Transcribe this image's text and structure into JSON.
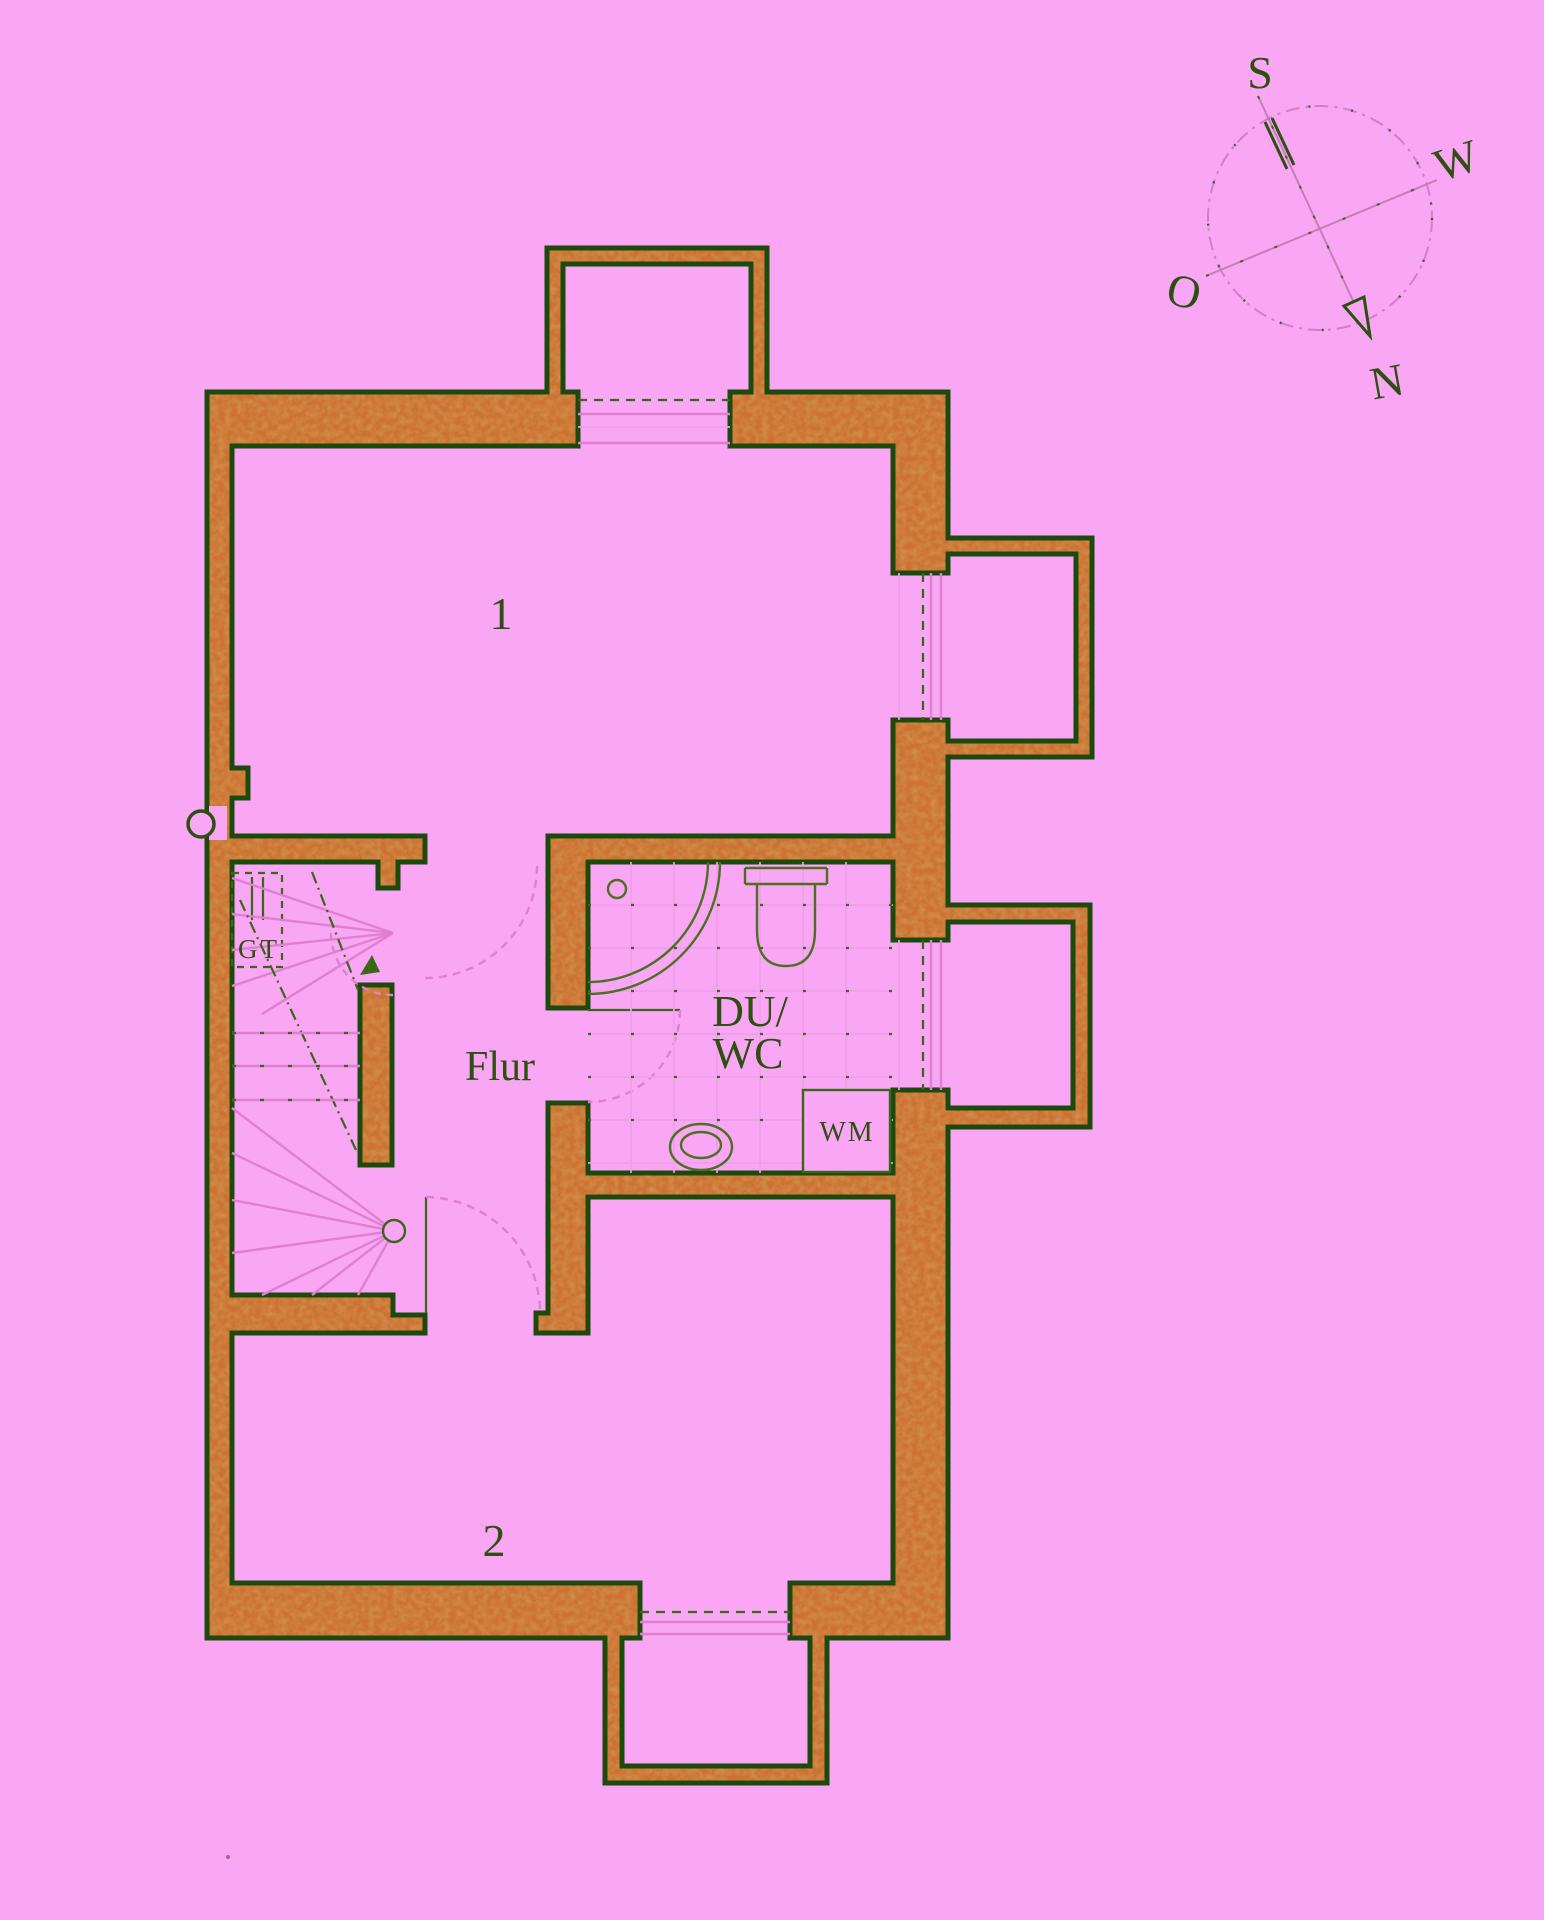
{
  "canvas": {
    "width": 1544,
    "height": 1920
  },
  "palette": {
    "background": "#f9a6f5",
    "wall_fill": "#cd7231",
    "wall_mottle": "#a3571a",
    "outline_green": "#1c4a0d",
    "line_pink": "#e07fd2",
    "line_green": "#3a6618",
    "text_green": "#2d4f10"
  },
  "rooms": {
    "room1": "1",
    "room2": "2",
    "hall": "Flur",
    "bath_line1": "DU/",
    "bath_line2": "WC",
    "washing_machine": "WM",
    "boiler": "GT"
  },
  "compass": {
    "south": "S",
    "west": "W",
    "east": "O",
    "north": "N"
  }
}
